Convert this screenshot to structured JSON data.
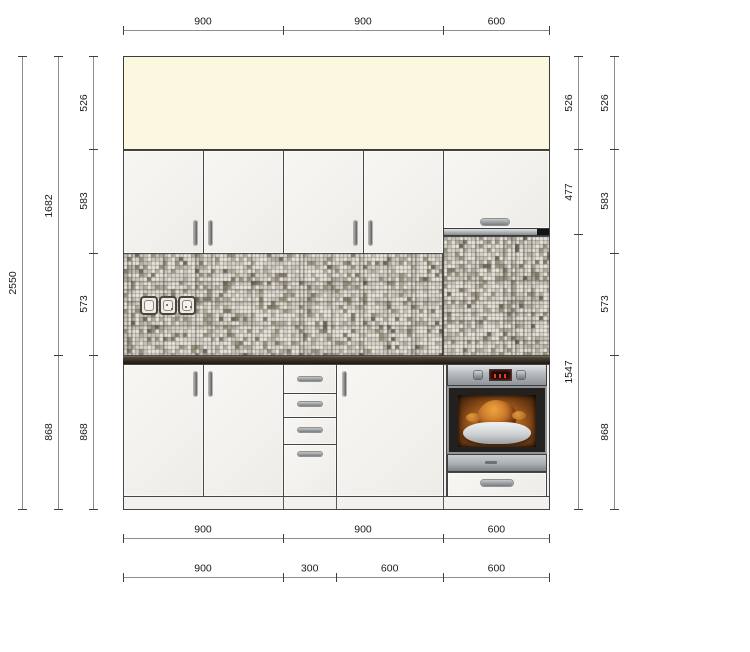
{
  "drawing": {
    "type": "kitchen-elevation",
    "colors": {
      "wall_band": "#fbf8df",
      "cabinet_face": "#f3f1ed",
      "outline": "#454545",
      "countertop": "#2f2720",
      "tile_light": "#d8d5cc",
      "tile_dark": "#827c6e",
      "steel": "#b4b9bd",
      "oven_glow": "#b06722",
      "dim_line": "#8e8e8e",
      "dim_text": "#1b1b1b"
    },
    "scale": {
      "px_per_mm": 0.1778,
      "origin_x": 123,
      "origin_y": 56
    },
    "dims": {
      "horizontal": [
        {
          "name": "top-width-chain",
          "y": 30,
          "values": [
            900,
            900,
            600
          ]
        },
        {
          "name": "bottom-width-chain-1",
          "y": 538,
          "values": [
            900,
            900,
            600
          ]
        },
        {
          "name": "bottom-width-chain-2",
          "y": 577,
          "values": [
            900,
            300,
            600,
            600
          ]
        }
      ],
      "vertical": [
        {
          "name": "left-outer-height",
          "x": 22,
          "values": [
            2550
          ]
        },
        {
          "name": "left-middle-height",
          "x": 58,
          "values": [
            1682,
            868
          ]
        },
        {
          "name": "left-inner-height",
          "x": 93,
          "values": [
            526,
            583,
            573,
            868
          ]
        },
        {
          "name": "right-inner-height",
          "x": 578,
          "values": [
            526,
            477,
            1547
          ]
        },
        {
          "name": "right-outer-height",
          "x": 614,
          "values": [
            526,
            583,
            573,
            868
          ]
        }
      ]
    },
    "components": {
      "wall_cabinets": [
        "double-door-900",
        "double-door-900",
        "single-door-600-above-oven"
      ],
      "base_cabinets": [
        "double-door-900",
        "drawer-unit-300-4-drawers",
        "single-door-600",
        "oven-housing-600"
      ],
      "appliance": "built-in-oven-with-roast",
      "outlets_count": 3
    }
  }
}
